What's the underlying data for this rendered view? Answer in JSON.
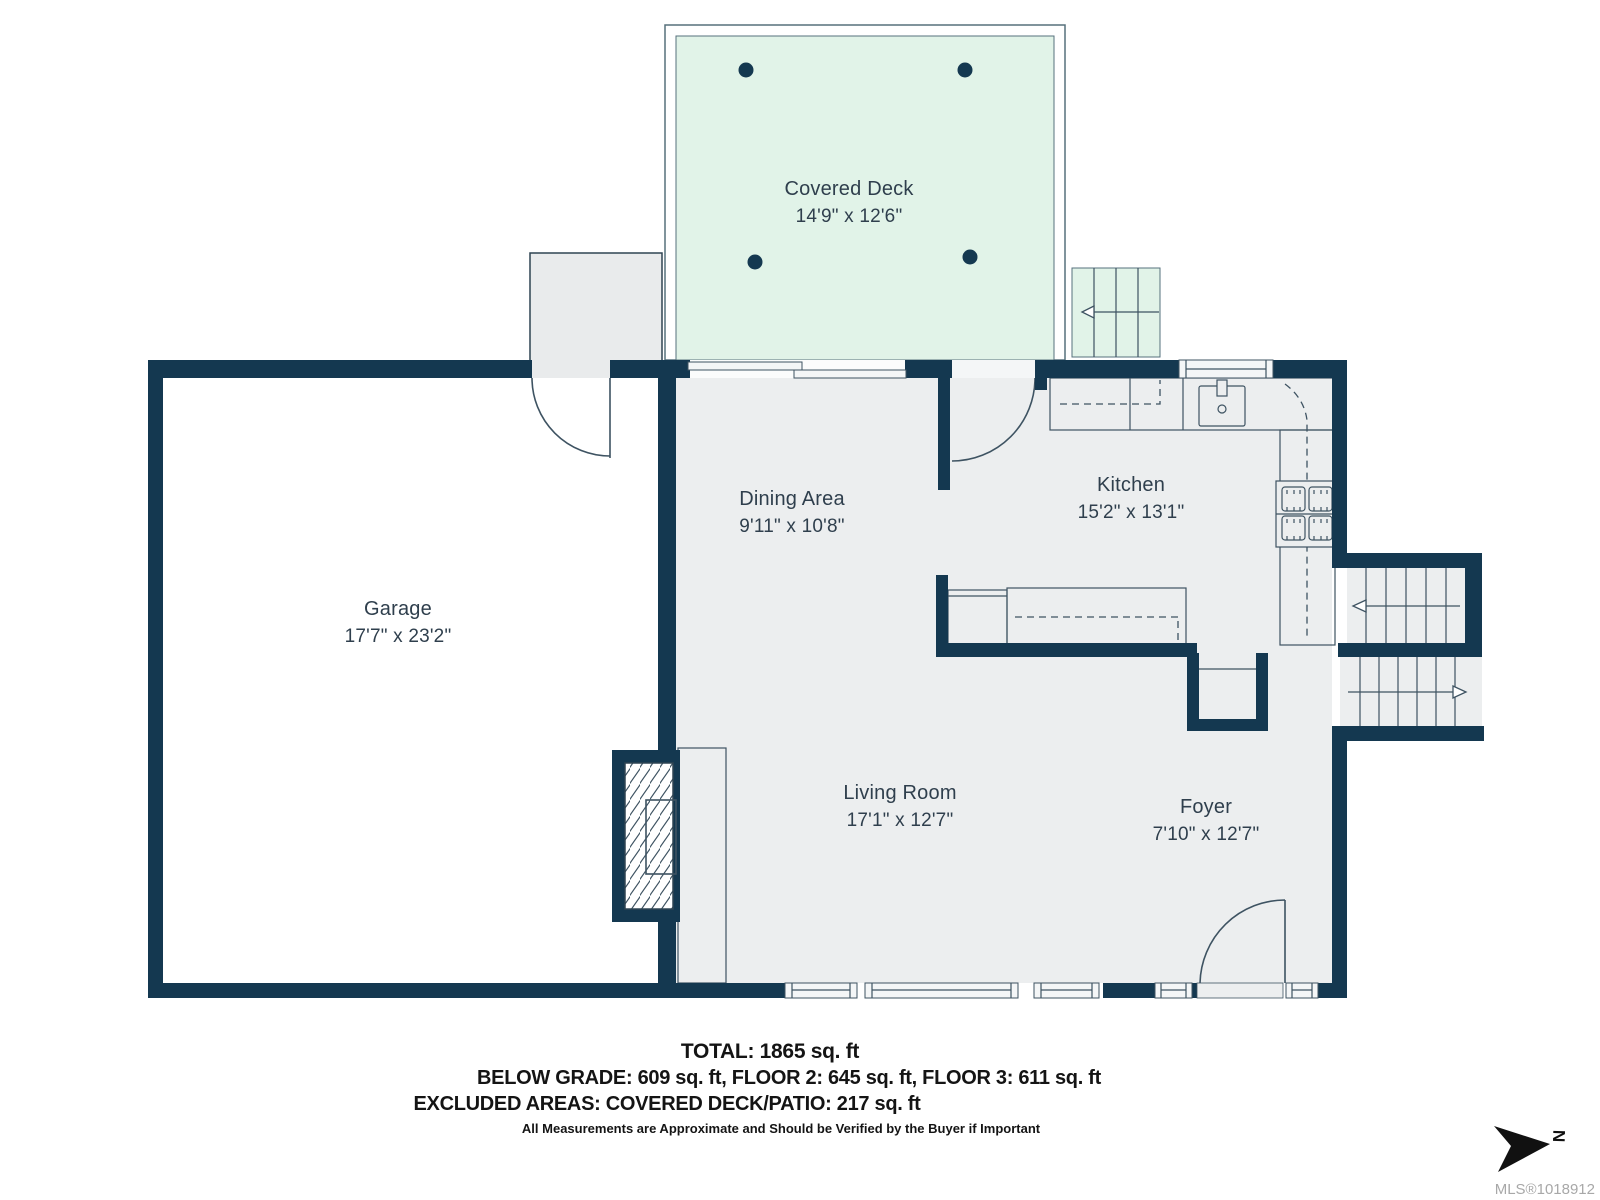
{
  "rooms": [
    {
      "name": "Covered Deck",
      "dims": "14'9\" x 12'6\""
    },
    {
      "name": "Garage",
      "dims": "17'7\" x 23'2\""
    },
    {
      "name": "Dining Area",
      "dims": "9'11\" x 10'8\""
    },
    {
      "name": "Kitchen",
      "dims": "15'2\" x 13'1\""
    },
    {
      "name": "Living Room",
      "dims": "17'1\" x 12'7\""
    },
    {
      "name": "Foyer",
      "dims": "7'10\" x 12'7\""
    }
  ],
  "summary": {
    "total": "TOTAL: 1865 sq. ft",
    "floors": "BELOW GRADE: 609 sq. ft, FLOOR 2: 645 sq. ft, FLOOR 3: 611 sq. ft",
    "excluded": "EXCLUDED AREAS: COVERED DECK/PATIO: 217 sq. ft",
    "disclaimer": "All Measurements are Approximate and Should be Verified by the Buyer if Important"
  },
  "mls": "MLS®1018912",
  "compass": {
    "label": "N"
  },
  "colors": {
    "wall": "#143850",
    "floor": "#eceeef",
    "deck": "#e1f3e8",
    "line": "#3e5362"
  }
}
